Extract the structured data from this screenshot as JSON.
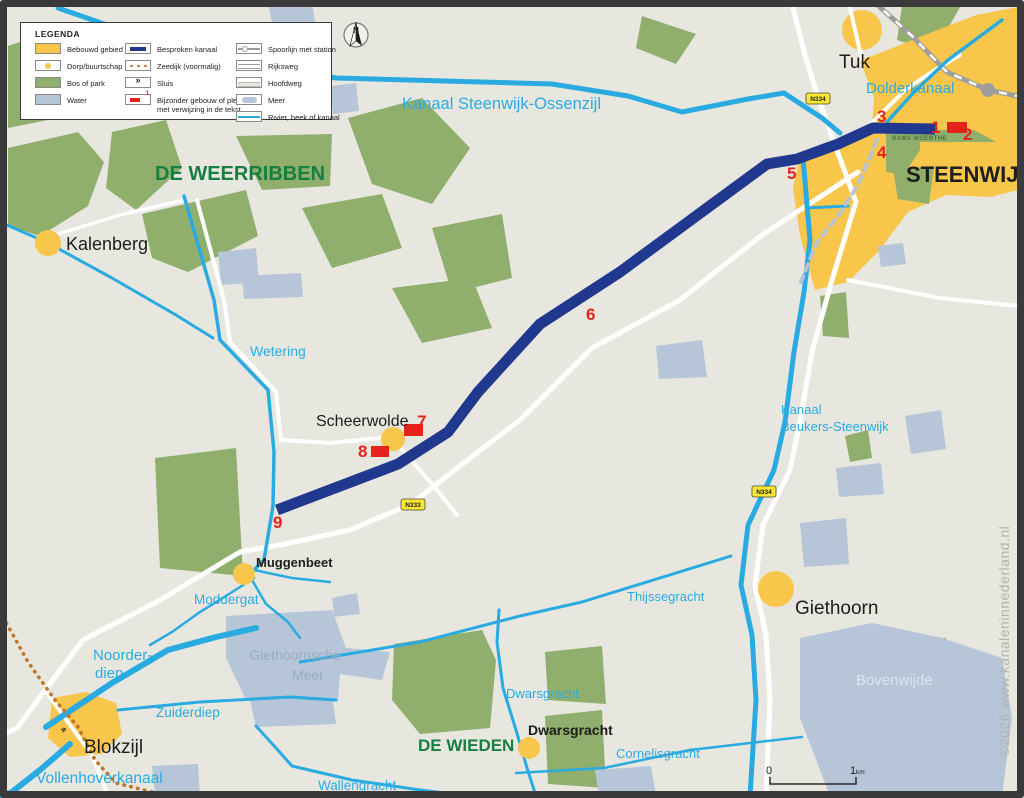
{
  "colors": {
    "land": "#e8e7df",
    "bos": "#90ae6c",
    "water": "#b6c5d8",
    "bebouwd": "#f7c64b",
    "kanaal": "#29abe2",
    "besproken": "#20398f",
    "red": "#e5231b",
    "road": "#ffffff",
    "rail": "#9d9d9d",
    "zeedijk": "#c0762a",
    "gdash": "#b9c2cf",
    "regiontxt": "#157f42",
    "laketxt": "#97abc4"
  },
  "legend": {
    "title": "LEGENDA",
    "sluis_glyph": "»",
    "bijzonder_badge": "1",
    "col1": [
      {
        "label": "Bebouwd gebied"
      },
      {
        "label": "Dorp/buurtschap"
      },
      {
        "label": "Bos of park"
      },
      {
        "label": "Water"
      }
    ],
    "col2": [
      {
        "label": "Besproken kanaal"
      },
      {
        "label": "Zeedijk (voormalig)"
      },
      {
        "label": "Sluis"
      },
      {
        "label": "Bijzonder gebouw of plek",
        "label2": "met verwijzing in de tekst"
      }
    ],
    "col3": [
      {
        "label": "Spoorlijn met station"
      },
      {
        "label": "Rijksweg"
      },
      {
        "label": "Hoofdweg"
      },
      {
        "label": "Meer"
      },
      {
        "label": "Rivier, beek of kanaal"
      }
    ]
  },
  "north_label": "N",
  "map": {
    "sluis_glyph": "»",
    "regions": {
      "weerribben": "DE WEERRIBBEN",
      "wieden": "DE WIEDEN"
    },
    "settlements": {
      "tuk": "Tuk",
      "steenwijk": "STEENWIJK",
      "kalenberg": "Kalenberg",
      "scheerwolde": "Scheerwolde",
      "muggenbeet": "Muggenbeet",
      "blokzijl": "Blokzijl",
      "dwarsgracht": "Dwarsgracht",
      "giethoorn": "Giethoorn"
    },
    "waterways": {
      "kanaal_steenwijk_ossenzijl": "Kanaal Steenwijk-Ossenzijl",
      "dolderkanaal": "Dolderkanaal",
      "wetering": "Wetering",
      "kanaal_beukers_line1": "Kanaal",
      "kanaal_beukers_line2": "Beukers-Steenwijk",
      "thijssegracht": "Thijssegracht",
      "moddergat": "Moddergat",
      "noorderdiep_line1": "Noorder-",
      "noorderdiep_line2": "diep",
      "zuiderdiep": "Zuiderdiep",
      "vollenhoverkanaal": "Vollenhoverkanaal",
      "dwarsgracht": "Dwarsgracht",
      "cornelisgracht": "Cornelisgracht",
      "wallengracht": "Wallengracht"
    },
    "lakes": {
      "giethoornsche_line1": "Giethoornsche",
      "giethoornsche_line2": "Meer",
      "bovenwijde": "Bovenwijde"
    },
    "parks": {
      "rams_woerthe": "RAMS WOERTHE"
    },
    "markers": [
      "1",
      "2",
      "3",
      "4",
      "5",
      "6",
      "7",
      "8",
      "9"
    ],
    "road_signs": {
      "n334": "N334",
      "n333": "N333"
    }
  },
  "scale_bar": {
    "start": "0",
    "end": "1",
    "unit": "km"
  },
  "watermark": "©2026 www.kanaleninnederland.nl"
}
